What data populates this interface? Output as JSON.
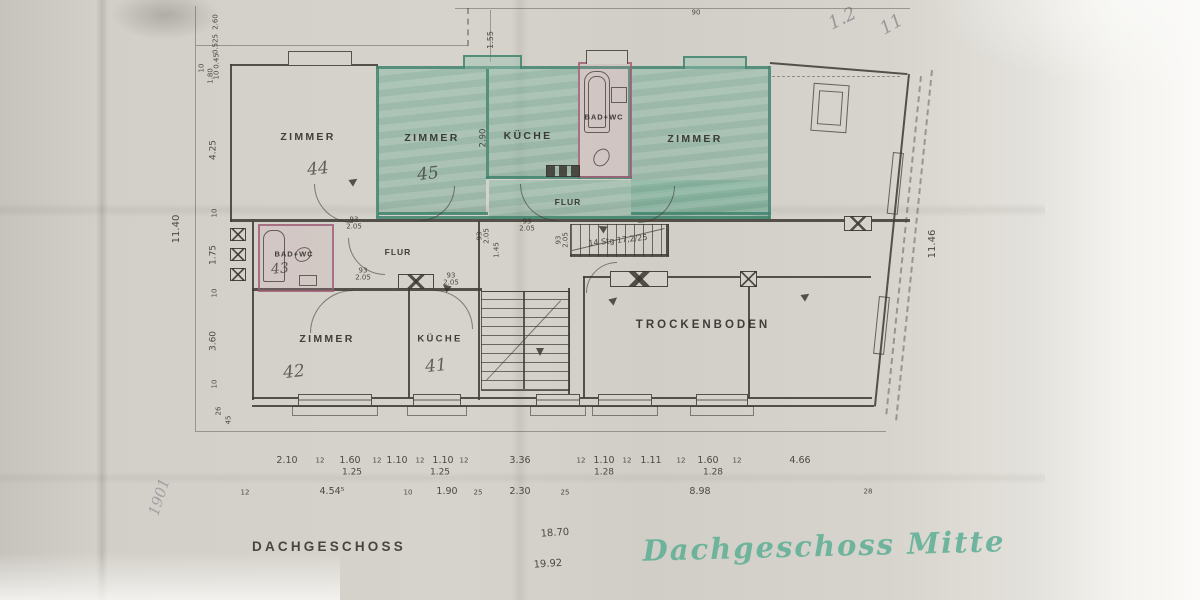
{
  "meta": {
    "sheet_title": "DACHGESCHOSS",
    "handwritten_title": "Dachgeschoss Mitte"
  },
  "rooms": {
    "zimmer44": {
      "label": "ZIMMER",
      "number": "44"
    },
    "zimmer45": {
      "label": "ZIMMER",
      "number": "45"
    },
    "kueche_top": {
      "label": "KÜCHE"
    },
    "badwc_top": {
      "label": "BAD+WC"
    },
    "zimmer_right": {
      "label": "ZIMMER"
    },
    "flur_top": {
      "label": "FLUR"
    },
    "badwc43": {
      "label": "BAD+WC",
      "number": "43"
    },
    "flur_left": {
      "label": "FLUR"
    },
    "zimmer42": {
      "label": "ZIMMER",
      "number": "42"
    },
    "kueche41": {
      "label": "KÜCHE",
      "number": "41"
    },
    "trockenboden": {
      "label": "TROCKENBODEN"
    }
  },
  "stairs": {
    "note": "14 Stg 17,2/25"
  },
  "door_label": {
    "width": "93",
    "height": "2.05"
  },
  "dims": {
    "left": [
      "2.60",
      "0.525",
      "0.45",
      "10",
      "4.25",
      "10",
      "1.75",
      "10",
      "3.60",
      "10",
      "26",
      "45",
      "10",
      "1.80"
    ],
    "outer_left": "11.40",
    "outer_right": "11.46",
    "top": [
      "90",
      "1.55",
      "2.90"
    ],
    "hall": "1.45",
    "row1": [
      "2.10",
      "12",
      "1.60",
      "12",
      "1.10",
      "12",
      "1.10",
      "12",
      "3.36",
      "12",
      "1.10",
      "12",
      "1.11",
      "12",
      "1.60",
      "12",
      "4.66"
    ],
    "row1b": [
      "1.25",
      "1.25",
      "1.28",
      "1.28"
    ],
    "row2": [
      "12",
      "4.54⁵",
      "10",
      "1.90",
      "25",
      "2.30",
      "25",
      "8.98",
      "28"
    ],
    "totals": [
      "18.70",
      "19.92"
    ]
  },
  "pencil": {
    "left": "1901",
    "top_right_a": "1.2",
    "top_right_b": "11"
  },
  "colors": {
    "flat_green": "#6fae93",
    "bath_pink": "#a2617b",
    "ink": "#45423c",
    "handwriting_green": "#5fb093",
    "paper": "#d4d1ca"
  }
}
